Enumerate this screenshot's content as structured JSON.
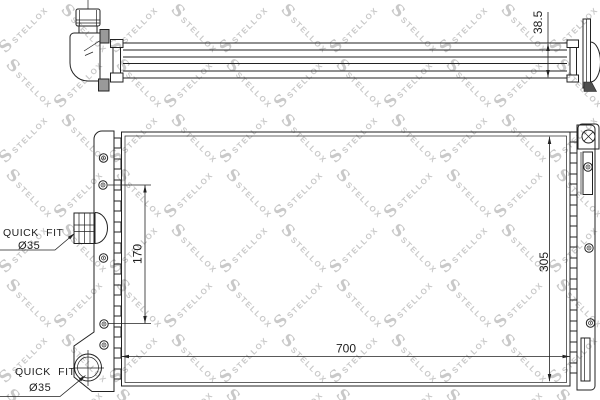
{
  "brand": {
    "letter": "S",
    "name": "STELLOX"
  },
  "watermark": {
    "color": "#c9c9c9"
  },
  "top_view": {
    "thickness_label": "38.5"
  },
  "front_view": {
    "pin_spacing_label": "170",
    "height_label": "305",
    "width_label": "700"
  },
  "callouts": {
    "upper": {
      "title": "QUICK FIT",
      "size": "Ø35"
    },
    "lower": {
      "title": "QUICK FIT",
      "size": "Ø35"
    }
  }
}
